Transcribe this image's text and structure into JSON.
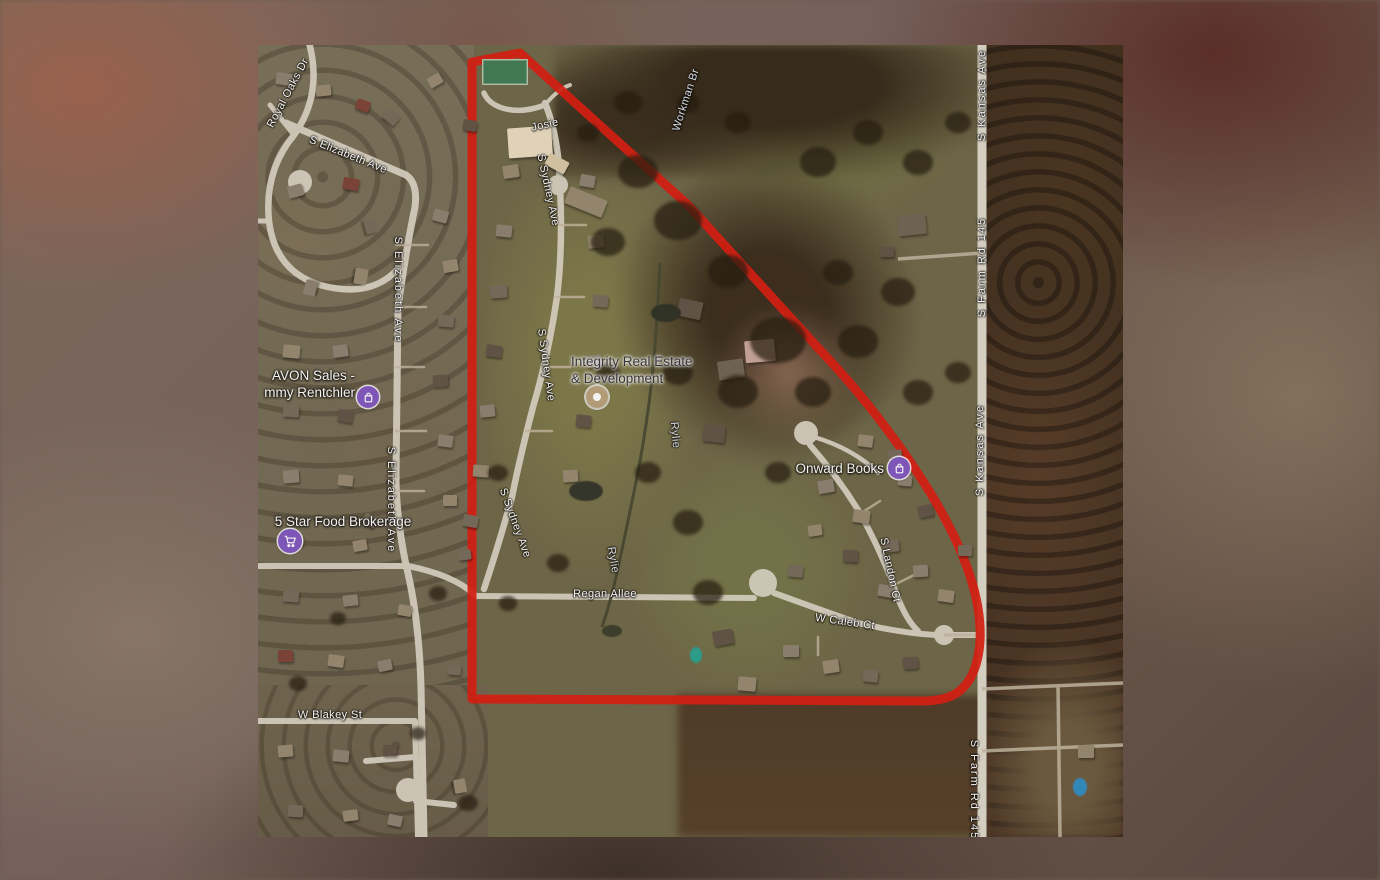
{
  "map": {
    "kind": "satellite-map-with-parcel-outline",
    "boundary_color": "#d91b10",
    "road_label_color": "#ffffff",
    "road_labels": [
      "Royal Oaks Dr",
      "S Elizabeth Ave",
      "S Elizabeth Ave",
      "S Elizabeth Ave",
      "W Blakey St",
      "Josie",
      "S Sydney Ave",
      "S Sydney Ave",
      "S Sydney Ave",
      "Regan Allee",
      "W Caleb Ct",
      "S Landon Ct",
      "S Kansas Ave",
      "S Farm Rd 145",
      "S Kansas Ave",
      "S Farm Rd 145"
    ],
    "water_labels": [
      "Workman Br",
      "Rylie",
      "Rylie"
    ],
    "businesses": [
      {
        "name_lines": [
          "AVON Sales -",
          "mmy Rentchler"
        ],
        "icon": "shopping-bag",
        "icon_color": "#7e57c2"
      },
      {
        "name_lines": [
          "5 Star Food Brokerage"
        ],
        "icon": "shopping-cart",
        "icon_color": "#7e57c2"
      },
      {
        "name_lines": [
          "Integrity Real Estate",
          "& Development"
        ],
        "icon": "business-dot",
        "icon_color": "#b9a17c"
      },
      {
        "name_lines": [
          "Onward Books"
        ],
        "icon": "shopping-bag",
        "icon_color": "#7e57c2"
      }
    ]
  }
}
